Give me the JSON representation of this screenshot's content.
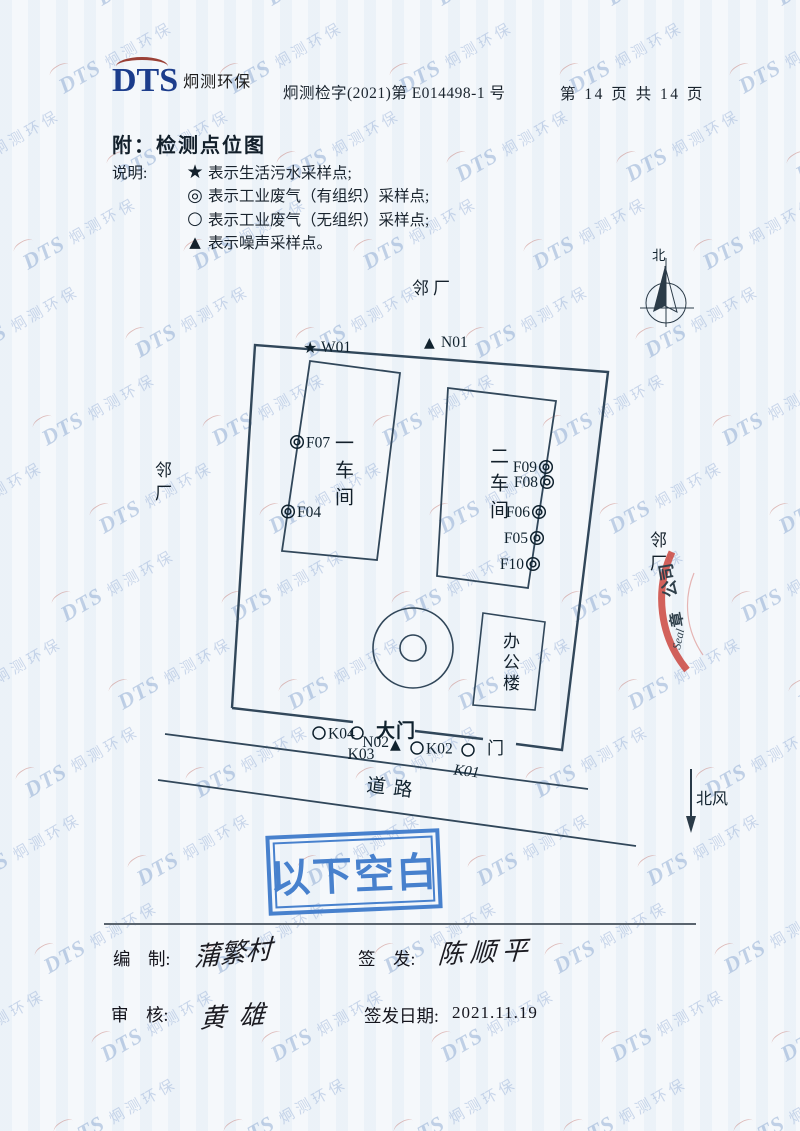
{
  "header": {
    "logo_dts": "DTS",
    "logo_company": "炯测环保",
    "doc_number": "炯测检字(2021)第 E014498-1 号",
    "page_info": "第 14 页 共 14 页"
  },
  "title": "附：检测点位图",
  "legend": {
    "label": "说明:",
    "items": [
      {
        "symbol": "★",
        "text": "表示生活污水采样点;"
      },
      {
        "symbol": "◎",
        "text": "表示工业废气（有组织）采样点;"
      },
      {
        "symbol": "○",
        "text": "表示工业废气（无组织）采样点;"
      },
      {
        "symbol": "▲",
        "text": "表示噪声采样点。"
      }
    ]
  },
  "map": {
    "neighbor_top": "邻厂",
    "neighbor_left": "邻厂",
    "neighbor_right": "邻厂",
    "compass_north": "北",
    "building1": "一车间",
    "building2": "二车间",
    "office": "办公楼",
    "gate_main": "大门",
    "gate_side": "门",
    "road": "道路",
    "north_wind": "北风",
    "symbols": {
      "star": "★",
      "triangle": "▲"
    },
    "points": {
      "w01": "W01",
      "n01": "N01",
      "n02": "N02",
      "f04": "F04",
      "f05": "F05",
      "f06": "F06",
      "f07": "F07",
      "f08": "F08",
      "f09": "F09",
      "f10": "F10",
      "k01": "K01",
      "k02": "K02",
      "k03": "K03",
      "k04": "K04"
    }
  },
  "stamps": {
    "blank_below": "以下空白",
    "red_seal": {
      "line1": "公司",
      "line2": "章",
      "line3": "Seal"
    }
  },
  "footer": {
    "prepared_label": "编    制:",
    "prepared_signature": "蒲繁村",
    "issued_label": "签    发:",
    "issued_signature": "陈顺平",
    "reviewed_label": "审    核:",
    "reviewed_signature": "黄雄",
    "date_label": "签发日期:",
    "date_value": "2021.11.19"
  },
  "watermark": {
    "dts": "DTS",
    "company": "炯测环保"
  }
}
